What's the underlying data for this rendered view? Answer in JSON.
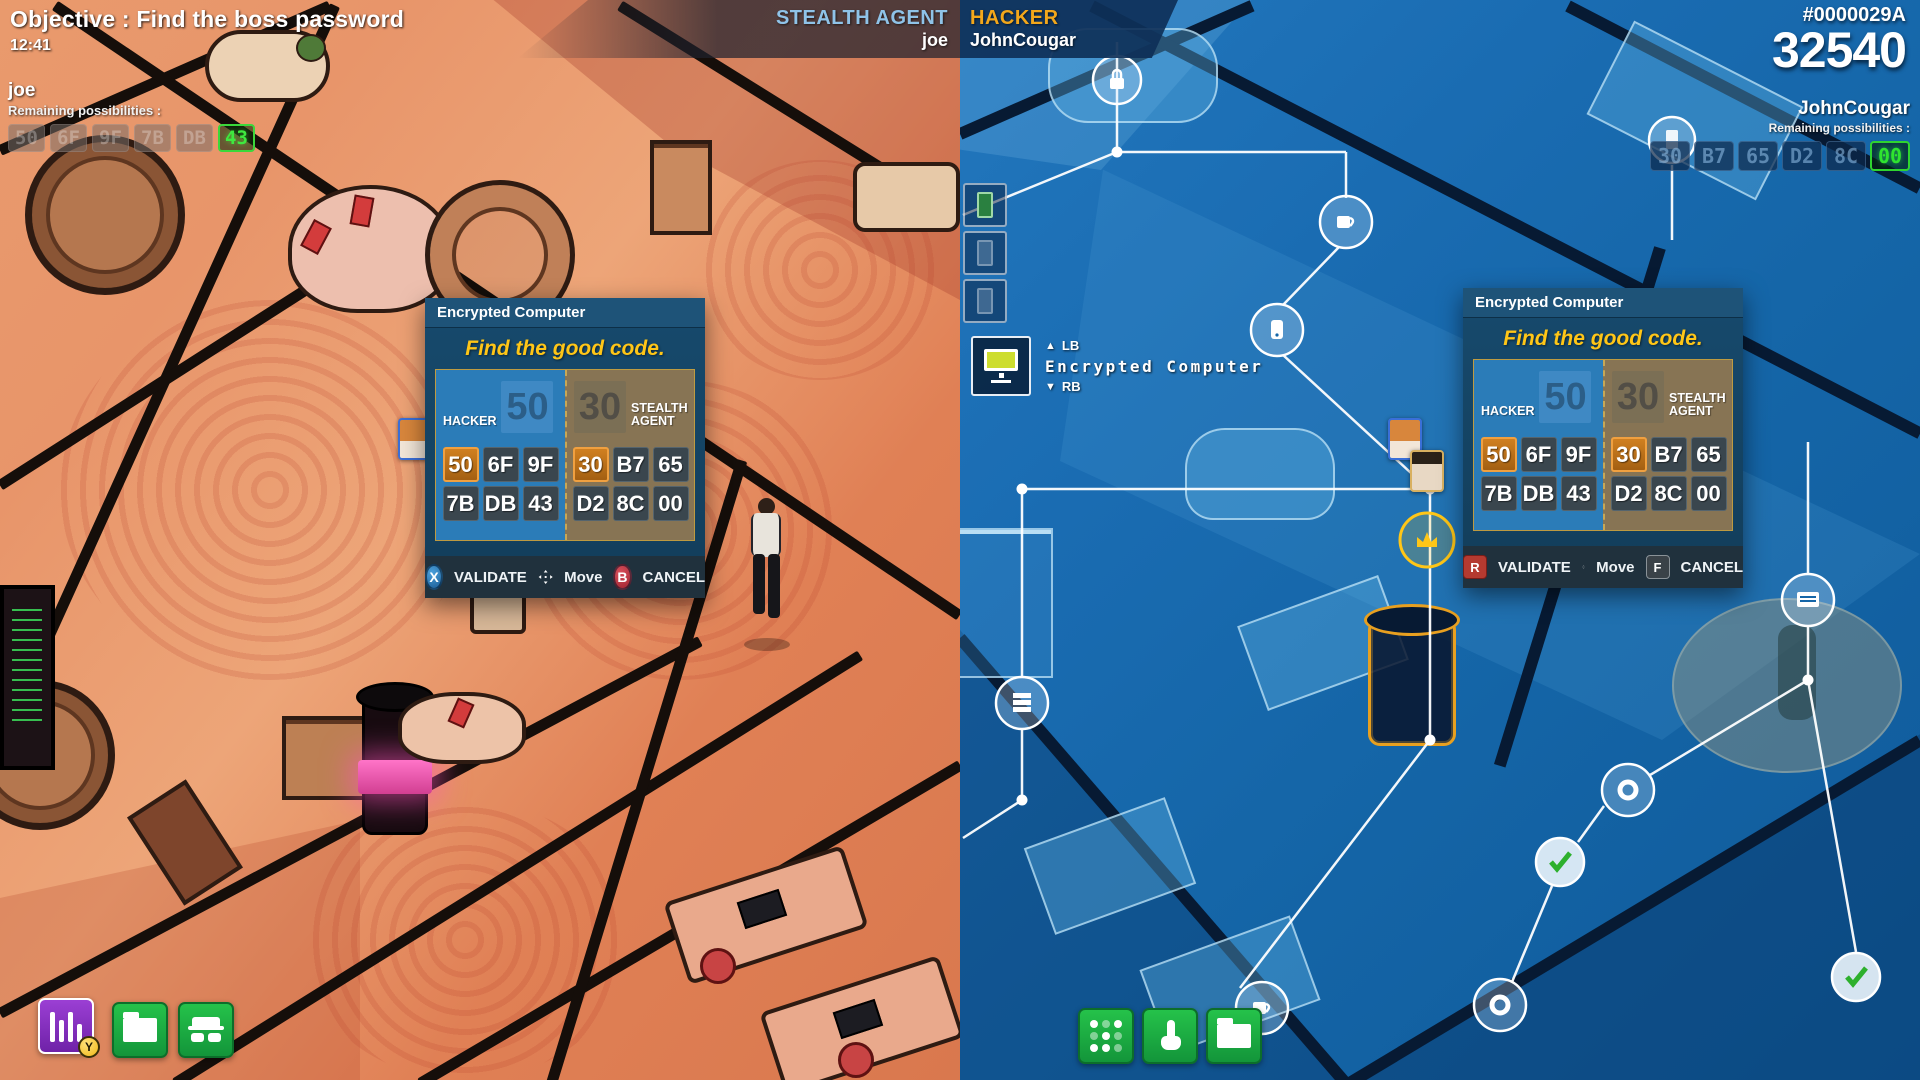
{
  "objective": {
    "label": "Objective : Find the boss password",
    "timer": "12:41"
  },
  "banner": {
    "stealth_role": "STEALTH AGENT",
    "stealth_name": "joe",
    "hacker_role": "HACKER",
    "hacker_name": "JohnCougar"
  },
  "score": {
    "session": "#0000029A",
    "points": "32540"
  },
  "agent_hud": {
    "name": "joe",
    "label": "Remaining possibilities :",
    "codes": [
      "50",
      "6F",
      "9F",
      "7B",
      "DB"
    ],
    "solved": "43"
  },
  "hacker_hud": {
    "name": "JohnCougar",
    "label": "Remaining possibilities :",
    "codes": [
      "30",
      "B7",
      "65",
      "D2",
      "8C"
    ],
    "solved": "00"
  },
  "dialog": {
    "title": "Encrypted Computer",
    "subtitle": "Find the good code.",
    "hacker_label": "HACKER",
    "stealth_label": "STEALTH AGENT",
    "hacker_big": "50",
    "stealth_big": "30",
    "hacker_codes": [
      "50",
      "6F",
      "9F",
      "7B",
      "DB",
      "43"
    ],
    "stealth_codes": [
      "30",
      "B7",
      "65",
      "D2",
      "8C",
      "00"
    ],
    "validate_label": "VALIDATE",
    "move_label": "Move",
    "cancel_label": "CANCEL",
    "agent_validate_key": "X",
    "agent_cancel_key": "B",
    "hacker_validate_key": "R",
    "hacker_cancel_key": "F"
  },
  "tooltip": {
    "up_key": "LB",
    "down_key": "RB",
    "label": "Encrypted Computer"
  },
  "badges": {
    "gadget_key": "Y"
  },
  "colors": {
    "accent_yellow": "#ffc617",
    "accent_green": "#35e035",
    "accent_orange": "#f2a71b",
    "hacker_blue": "#2b7cb8",
    "agent_tan": "#877454",
    "selected_orange": "#c87a1e",
    "hud_green": "#3fe83f"
  }
}
